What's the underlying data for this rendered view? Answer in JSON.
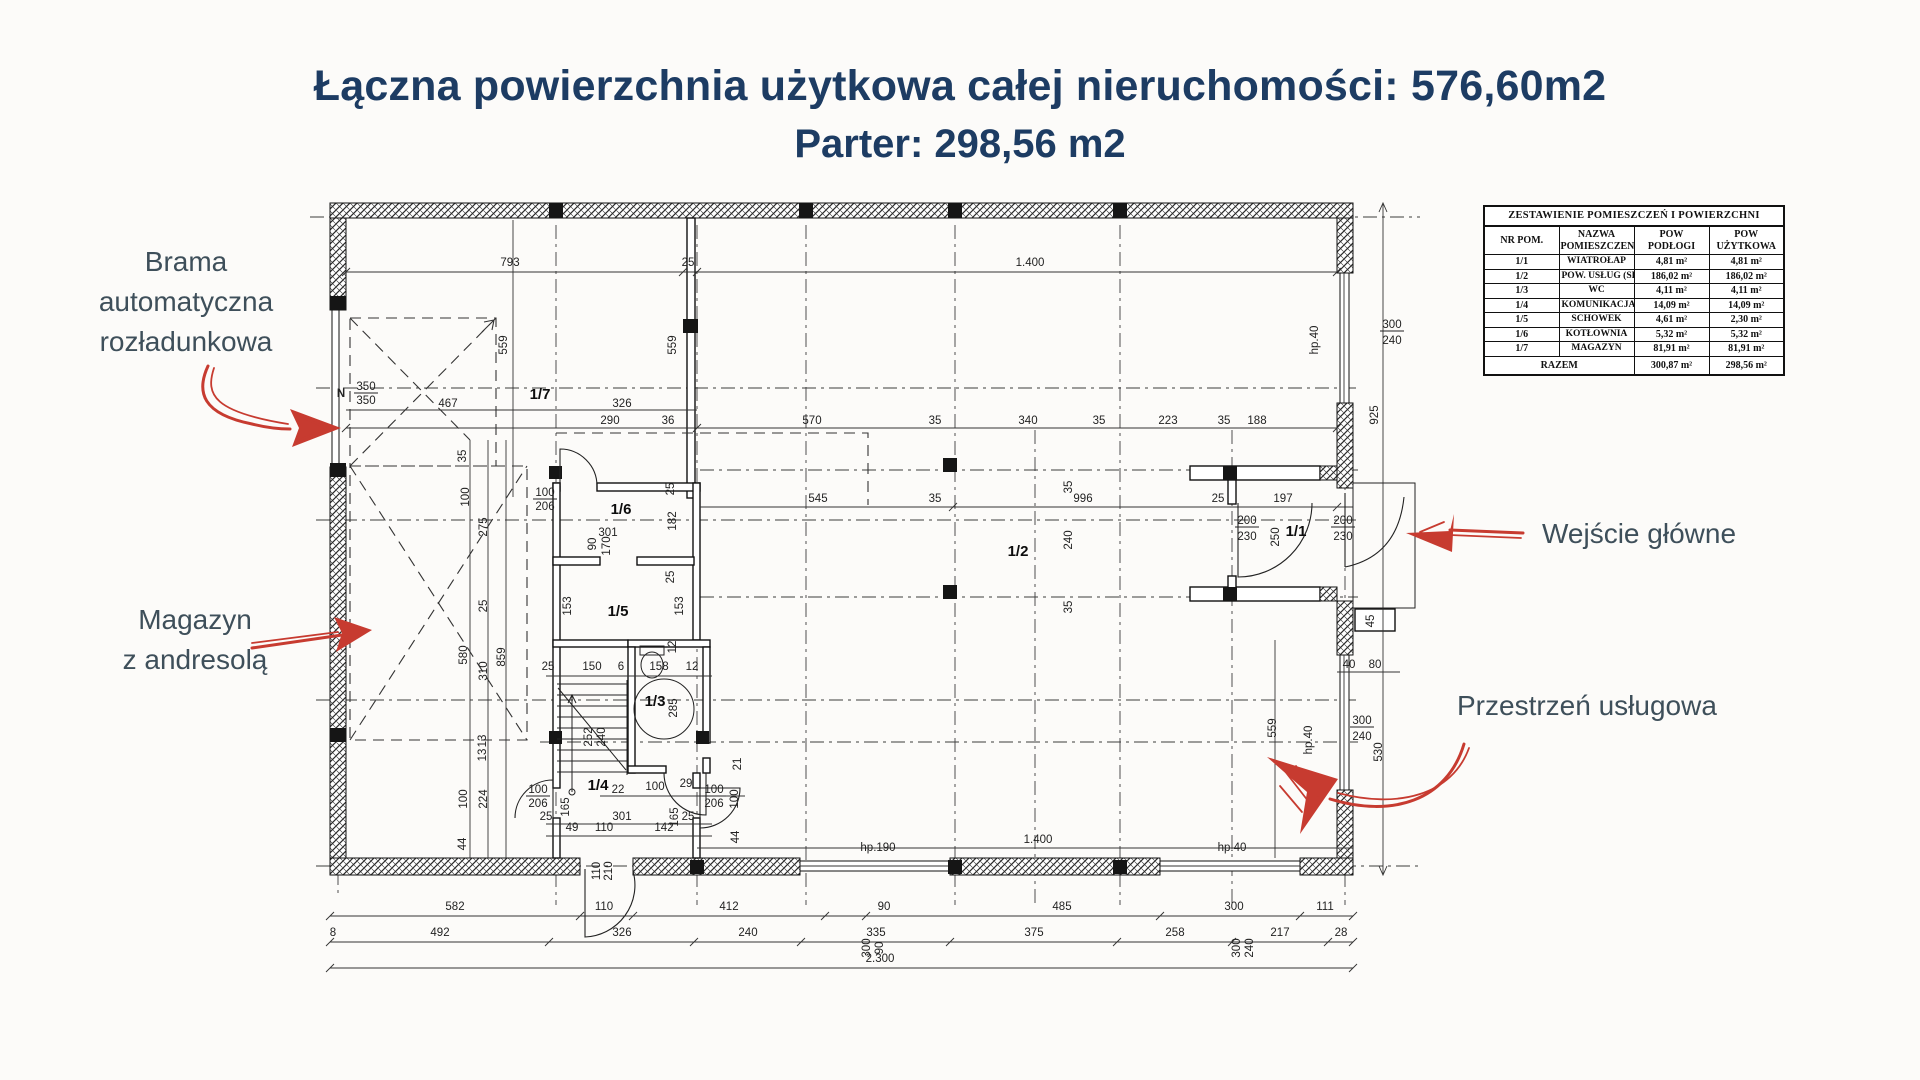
{
  "colors": {
    "navy": "#1d3c63",
    "slate": "#3e4f5a",
    "arrow": "#c73b30",
    "bg": "#fcfbf9"
  },
  "title": {
    "line1": "Łączna powierzchnia użytkowa całej nieruchomości: 576,60m2",
    "line2": "Parter: 298,56 m2"
  },
  "annotations": {
    "brama": {
      "lines": [
        "Brama",
        "automatyczna",
        "rozładunkowa"
      ]
    },
    "magazyn": {
      "lines": [
        "Magazyn",
        "z andresolą"
      ]
    },
    "wejscie": {
      "lines": [
        "Wejście główne"
      ]
    },
    "przestrzen": {
      "lines": [
        "Przestrzeń usługowa"
      ]
    }
  },
  "legend_table": {
    "title": "ZESTAWIENIE POMIESZCZEŃ I POWIERZCHNI",
    "headers": [
      "NR POM.",
      "NAZWA POMIESZCZENIA",
      "POW PODŁOGI",
      "POW UŻYTKOWA"
    ],
    "rows": [
      [
        "1/1",
        "WIATROŁAP",
        "4,81 m²",
        "4,81 m²"
      ],
      [
        "1/2",
        "POW. USŁUG (SKLEP)",
        "186,02 m²",
        "186,02 m²"
      ],
      [
        "1/3",
        "WC",
        "4,11 m²",
        "4,11 m²"
      ],
      [
        "1/4",
        "KOMUNIKACJA",
        "14,09 m²",
        "14,09 m²"
      ],
      [
        "1/5",
        "SCHOWEK",
        "4,61 m²",
        "2,30 m²"
      ],
      [
        "1/6",
        "KOTŁOWNIA",
        "5,32 m²",
        "5,32 m²"
      ],
      [
        "1/7",
        "MAGAZYN",
        "81,91 m²",
        "81,91 m²"
      ]
    ],
    "total_label": "RAZEM",
    "total_floor": "300,87 m²",
    "total_usable": "298,56 m²"
  },
  "plan": {
    "rooms": [
      {
        "t": "1/7",
        "x": 540,
        "y": 399
      },
      {
        "t": "1/6",
        "x": 621,
        "y": 514
      },
      {
        "t": "1/5",
        "x": 618,
        "y": 616
      },
      {
        "t": "1/3",
        "x": 655,
        "y": 706
      },
      {
        "t": "1/4",
        "x": 598,
        "y": 790
      },
      {
        "t": "1/2",
        "x": 1018,
        "y": 556
      },
      {
        "t": "1/1",
        "x": 1296,
        "y": 536
      }
    ],
    "texts": [
      {
        "t": "793",
        "x": 510,
        "y": 266
      },
      {
        "t": "25",
        "x": 688,
        "y": 266
      },
      {
        "t": "1.400",
        "x": 1030,
        "y": 266
      },
      {
        "t": "467",
        "x": 448,
        "y": 407
      },
      {
        "t": "326",
        "x": 622,
        "y": 407
      },
      {
        "t": "290",
        "x": 610,
        "y": 424
      },
      {
        "t": "36",
        "x": 668,
        "y": 424
      },
      {
        "t": "570",
        "x": 812,
        "y": 424
      },
      {
        "t": "35",
        "x": 935,
        "y": 424
      },
      {
        "t": "340",
        "x": 1028,
        "y": 424
      },
      {
        "t": "35",
        "x": 1099,
        "y": 424
      },
      {
        "t": "223",
        "x": 1168,
        "y": 424
      },
      {
        "t": "35",
        "x": 1224,
        "y": 424
      },
      {
        "t": "188",
        "x": 1257,
        "y": 424
      },
      {
        "t": "350",
        "x": 366,
        "y": 390,
        "u": 1
      },
      {
        "t": "350",
        "x": 366,
        "y": 404
      },
      {
        "t": "N",
        "x": 341,
        "y": 397,
        "f": 12,
        "b": 1
      },
      {
        "t": "545",
        "x": 818,
        "y": 502
      },
      {
        "t": "35",
        "x": 935,
        "y": 502
      },
      {
        "t": "996",
        "x": 1083,
        "y": 502
      },
      {
        "t": "25",
        "x": 1218,
        "y": 502
      },
      {
        "t": "197",
        "x": 1283,
        "y": 502
      },
      {
        "t": "301",
        "x": 608,
        "y": 536
      },
      {
        "t": "25",
        "x": 548,
        "y": 670
      },
      {
        "t": "150",
        "x": 592,
        "y": 670
      },
      {
        "t": "6",
        "x": 621,
        "y": 670
      },
      {
        "t": "158",
        "x": 659,
        "y": 670
      },
      {
        "t": "12",
        "x": 692,
        "y": 670
      },
      {
        "t": "22",
        "x": 618,
        "y": 793
      },
      {
        "t": "100",
        "x": 655,
        "y": 790
      },
      {
        "t": "29",
        "x": 686,
        "y": 787
      },
      {
        "t": "100",
        "x": 714,
        "y": 793,
        "u": 1
      },
      {
        "t": "206",
        "x": 714,
        "y": 807
      },
      {
        "t": "100",
        "x": 538,
        "y": 793,
        "u": 1
      },
      {
        "t": "206",
        "x": 538,
        "y": 807
      },
      {
        "t": "100",
        "x": 545,
        "y": 496,
        "u": 1
      },
      {
        "t": "206",
        "x": 545,
        "y": 510
      },
      {
        "t": "301",
        "x": 622,
        "y": 820
      },
      {
        "t": "49",
        "x": 572,
        "y": 831
      },
      {
        "t": "110",
        "x": 604,
        "y": 831
      },
      {
        "t": "142",
        "x": 664,
        "y": 831
      },
      {
        "t": "25",
        "x": 546,
        "y": 820
      },
      {
        "t": "25",
        "x": 688,
        "y": 820
      },
      {
        "t": "hp.190",
        "x": 878,
        "y": 851,
        "f": 10
      },
      {
        "t": "hp.40",
        "x": 1232,
        "y": 851,
        "f": 10
      },
      {
        "t": "1.400",
        "x": 1038,
        "y": 843
      },
      {
        "t": "300",
        "x": 1392,
        "y": 328,
        "u": 1
      },
      {
        "t": "240",
        "x": 1392,
        "y": 344
      },
      {
        "t": "40",
        "x": 1349,
        "y": 668
      },
      {
        "t": "80",
        "x": 1375,
        "y": 668
      },
      {
        "t": "300",
        "x": 1362,
        "y": 724,
        "u": 1
      },
      {
        "t": "240",
        "x": 1362,
        "y": 740
      },
      {
        "t": "200",
        "x": 1247,
        "y": 524,
        "u": 1
      },
      {
        "t": "230",
        "x": 1247,
        "y": 540
      },
      {
        "t": "200",
        "x": 1343,
        "y": 524,
        "u": 1
      },
      {
        "t": "230",
        "x": 1343,
        "y": 540
      },
      {
        "t": "582",
        "x": 455,
        "y": 910
      },
      {
        "t": "110",
        "x": 604,
        "y": 910
      },
      {
        "t": "412",
        "x": 729,
        "y": 910
      },
      {
        "t": "90",
        "x": 884,
        "y": 910
      },
      {
        "t": "485",
        "x": 1062,
        "y": 910
      },
      {
        "t": "300",
        "x": 1234,
        "y": 910
      },
      {
        "t": "111",
        "x": 1325,
        "y": 910
      },
      {
        "t": "492",
        "x": 440,
        "y": 936
      },
      {
        "t": "326",
        "x": 622,
        "y": 936
      },
      {
        "t": "240",
        "x": 748,
        "y": 936
      },
      {
        "t": "335",
        "x": 876,
        "y": 936
      },
      {
        "t": "375",
        "x": 1034,
        "y": 936
      },
      {
        "t": "258",
        "x": 1175,
        "y": 936
      },
      {
        "t": "217",
        "x": 1280,
        "y": 936
      },
      {
        "t": "28",
        "x": 1341,
        "y": 936
      },
      {
        "t": "2.300",
        "x": 880,
        "y": 962
      },
      {
        "t": "8",
        "x": 333,
        "y": 936,
        "f": 10
      },
      {
        "t": "559",
        "x": 507,
        "y": 345,
        "r": 1
      },
      {
        "t": "559",
        "x": 676,
        "y": 345,
        "r": 1
      },
      {
        "t": "925",
        "x": 1378,
        "y": 415,
        "r": 1
      },
      {
        "t": "559",
        "x": 1276,
        "y": 728,
        "r": 1
      },
      {
        "t": "hp.40",
        "x": 1318,
        "y": 340,
        "r": 1,
        "f": 9
      },
      {
        "t": "hp.40",
        "x": 1312,
        "y": 740,
        "r": 1,
        "f": 9
      },
      {
        "t": "530",
        "x": 1382,
        "y": 752,
        "r": 1
      },
      {
        "t": "35",
        "x": 466,
        "y": 456,
        "r": 1
      },
      {
        "t": "100",
        "x": 469,
        "y": 497,
        "r": 1
      },
      {
        "t": "275",
        "x": 487,
        "y": 527,
        "r": 1
      },
      {
        "t": "25",
        "x": 487,
        "y": 606,
        "r": 1
      },
      {
        "t": "580",
        "x": 467,
        "y": 655,
        "r": 1
      },
      {
        "t": "310",
        "x": 487,
        "y": 671,
        "r": 1
      },
      {
        "t": "859",
        "x": 505,
        "y": 657,
        "r": 1
      },
      {
        "t": "13",
        "x": 486,
        "y": 741,
        "r": 1
      },
      {
        "t": "13",
        "x": 486,
        "y": 755,
        "r": 1
      },
      {
        "t": "100",
        "x": 467,
        "y": 799,
        "r": 1
      },
      {
        "t": "224",
        "x": 487,
        "y": 799,
        "r": 1
      },
      {
        "t": "44",
        "x": 466,
        "y": 844,
        "r": 1
      },
      {
        "t": "182",
        "x": 676,
        "y": 521,
        "r": 1
      },
      {
        "t": "25",
        "x": 674,
        "y": 489,
        "r": 1
      },
      {
        "t": "25",
        "x": 674,
        "y": 577,
        "r": 1
      },
      {
        "t": "153",
        "x": 571,
        "y": 606,
        "r": 1
      },
      {
        "t": "153",
        "x": 683,
        "y": 606,
        "r": 1
      },
      {
        "t": "90",
        "x": 596,
        "y": 544,
        "r": 1
      },
      {
        "t": "170",
        "x": 610,
        "y": 546,
        "r": 1
      },
      {
        "t": "12",
        "x": 676,
        "y": 647,
        "r": 1
      },
      {
        "t": "285",
        "x": 677,
        "y": 708,
        "r": 1
      },
      {
        "t": "165",
        "x": 569,
        "y": 807,
        "r": 1
      },
      {
        "t": "165",
        "x": 678,
        "y": 817,
        "r": 1
      },
      {
        "t": "21",
        "x": 741,
        "y": 764,
        "r": 1
      },
      {
        "t": "100",
        "x": 738,
        "y": 799,
        "r": 1
      },
      {
        "t": "44",
        "x": 739,
        "y": 837,
        "r": 1
      },
      {
        "t": "45",
        "x": 1374,
        "y": 621,
        "r": 1
      },
      {
        "t": "110",
        "x": 600,
        "y": 871,
        "r": 1
      },
      {
        "t": "210",
        "x": 612,
        "y": 871,
        "r": 1
      },
      {
        "t": "35",
        "x": 1072,
        "y": 487,
        "r": 1
      },
      {
        "t": "240",
        "x": 1072,
        "y": 540,
        "r": 1
      },
      {
        "t": "35",
        "x": 1072,
        "y": 607,
        "r": 1
      },
      {
        "t": "252",
        "x": 592,
        "y": 737,
        "r": 1,
        "f": 9
      },
      {
        "t": "240",
        "x": 605,
        "y": 737,
        "r": 1,
        "f": 9
      },
      {
        "t": "300",
        "x": 870,
        "y": 948,
        "r": 1
      },
      {
        "t": "90",
        "x": 883,
        "y": 948,
        "r": 1
      },
      {
        "t": "300",
        "x": 1240,
        "y": 948,
        "r": 1
      },
      {
        "t": "240",
        "x": 1253,
        "y": 948,
        "r": 1
      },
      {
        "t": "250",
        "x": 1279,
        "y": 537,
        "r": 1
      }
    ]
  }
}
